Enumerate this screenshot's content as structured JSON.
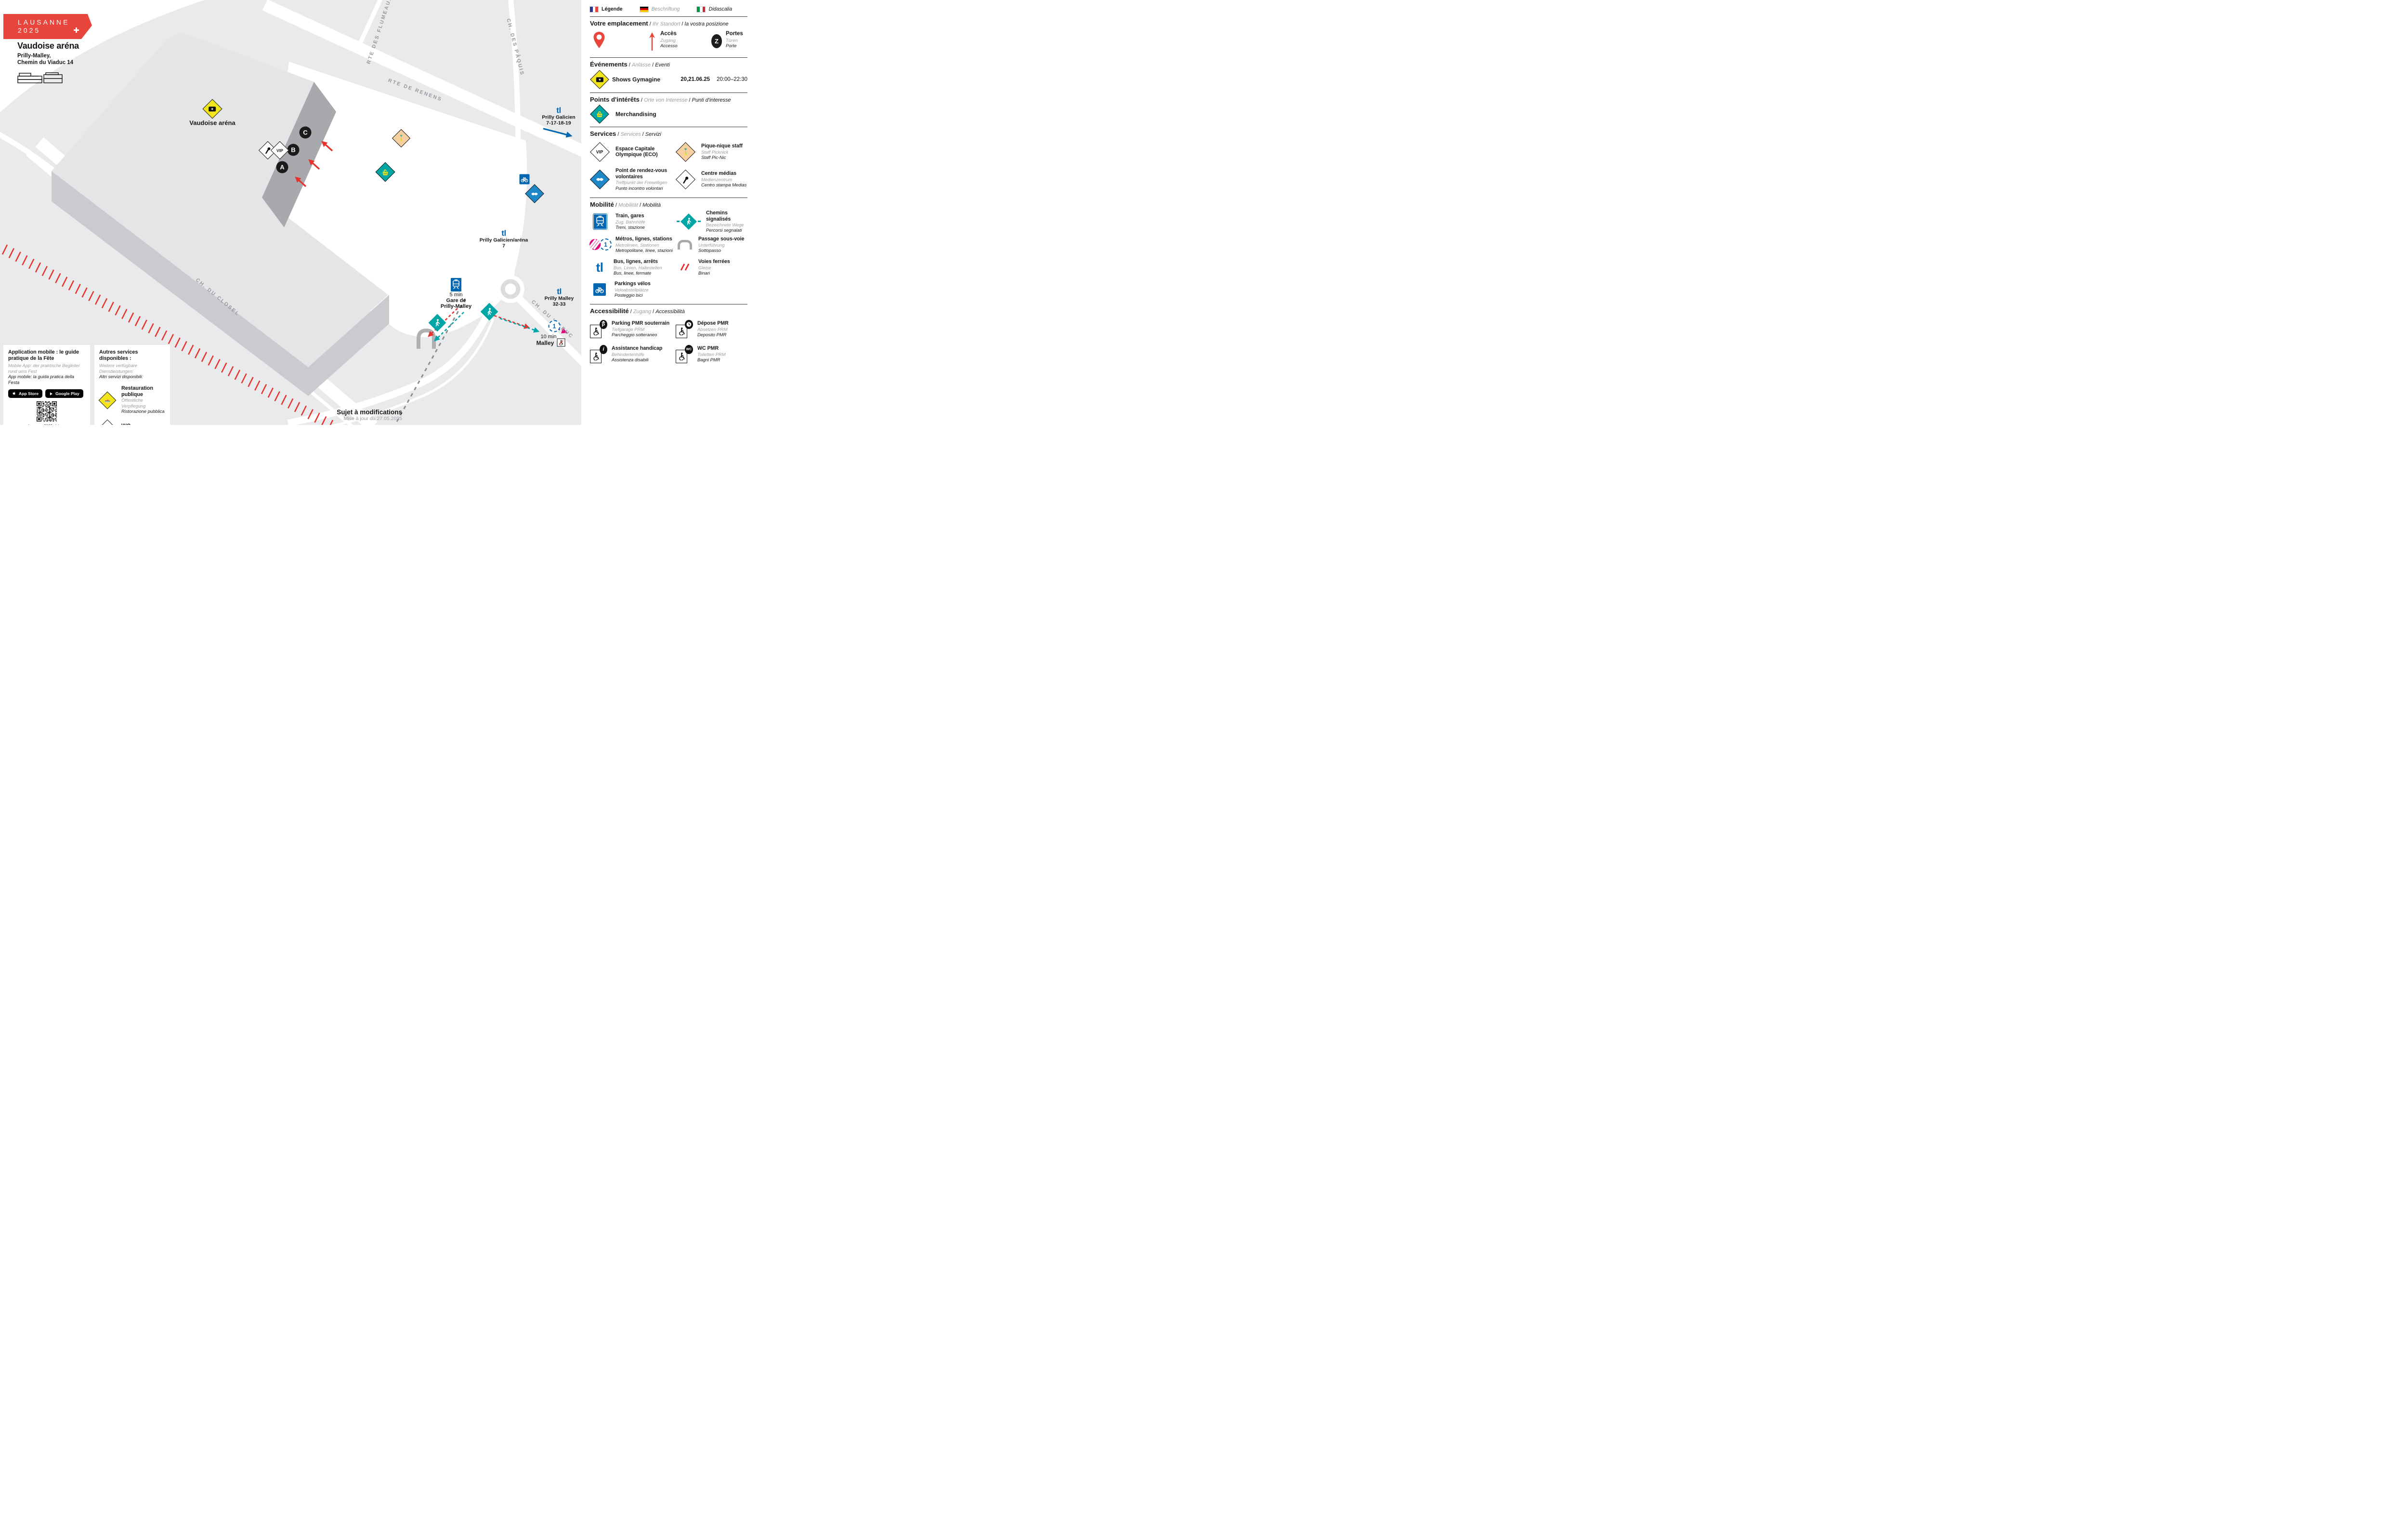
{
  "header": {
    "logo_line1": "LAUSANNE",
    "logo_line2": "2025",
    "title": "Vaudoise aréna",
    "address_line1": "Prilly-Malley,",
    "address_line2": "Chemin du Viaduc 14"
  },
  "map": {
    "arena_label": "Vaudoise aréna",
    "vip_label": "VIP",
    "doors": [
      "A",
      "B",
      "C"
    ],
    "roads": {
      "flumeaux": "RTE DES FLUMEAUX",
      "renens": "RTE DE RENENS",
      "paquis": "CH. DES PÂQUIS",
      "closel": "CH. DU CLOSEL",
      "viaduc": "CH. DU VIADUC"
    },
    "stops": {
      "galicien": {
        "logo": "tl",
        "name": "Prilly Galicien",
        "lines": "7-17-18-19"
      },
      "galicien_arena": {
        "logo": "tl",
        "name": "Prilly Galicien/aréna",
        "lines": "7"
      },
      "malley": {
        "logo": "tl",
        "name": "Prilly Malley",
        "lines": "32-33"
      }
    },
    "gare": {
      "time": "5 min",
      "name_line1": "Gare de",
      "name_line2": "Prilly-Malley"
    },
    "metro": {
      "line": "1",
      "time": "10 min",
      "name": "Malley"
    },
    "note": "Sujet à modifications",
    "updated": "Mise à jour du 27.05.2025"
  },
  "legend": {
    "languages": [
      {
        "label": "Légende"
      },
      {
        "label": "Beschriftung"
      },
      {
        "label": "Didascalia"
      }
    ],
    "location": {
      "fr": "Votre emplacement",
      "de": "Ihr Standort",
      "it": "la vostra posizione",
      "acces": {
        "fr": "Accès",
        "de": "Zugang",
        "it": "Accesso"
      },
      "portes": {
        "fr": "Portes",
        "de": "Türen",
        "it": "Porte",
        "badge": "Z"
      }
    },
    "events": {
      "fr": "Événements",
      "de": "Anlässe",
      "it": "Eventi",
      "rows": [
        {
          "label": "Shows Gymagine",
          "dates": "20,21.06.25",
          "time": "20:00–22:30"
        }
      ]
    },
    "poi": {
      "fr": "Points d'intérêts",
      "de": "Orte von Interesse",
      "it": "Punti d'interesse",
      "rows": [
        {
          "label": "Merchandising"
        }
      ]
    },
    "services": {
      "fr": "Services",
      "de": "Services",
      "it": "Servizi",
      "items": [
        {
          "fr": "Espace Capitale Olympique (ECO)",
          "de": "",
          "it": ""
        },
        {
          "fr": "Pique-nique staff",
          "de": "Staff Picknick",
          "it": "Staff Pic-Nic"
        },
        {
          "fr": "Point de rendez-vous volontaires",
          "de": "Treffpunkt der Freiwilligen",
          "it": "Punto incontro volontari"
        },
        {
          "fr": "Centre médias",
          "de": "Medienzentrum",
          "it": "Centro stampa Medias"
        }
      ]
    },
    "mobility": {
      "fr": "Mobilité",
      "de": "Mobilität",
      "it": "Mobilità",
      "items": [
        {
          "fr": "Train, gares",
          "de": "Zug, Bahnhöfe",
          "it": "Treni, stazione"
        },
        {
          "fr": "Chemins signalisés",
          "de": "Bezeichnete Wege",
          "it": "Percorsi segnalati"
        },
        {
          "fr": "Métros, lignes, stations",
          "de": "Metrolinien, Stationen",
          "it": "Metropolitane, linee, stazioni"
        },
        {
          "fr": "Passage sous-voie",
          "de": "Unterführung",
          "it": "Sottopasso"
        },
        {
          "fr": "Bus, lignes, arrêts",
          "de": "Bus, Linien, Haltestellen",
          "it": "Bus, linee, fermate"
        },
        {
          "fr": "Voies ferrées",
          "de": "Gleise",
          "it": "Binari"
        },
        {
          "fr": "Parkings vélos",
          "de": "Veloabstellplätze",
          "it": "Posteggio bici"
        }
      ]
    },
    "access": {
      "fr": "Accessibilité",
      "de": "Zugang",
      "it": "Accessibilità",
      "items": [
        {
          "fr": "Parking PMR souterrain",
          "de": "Tiefgarage PRM",
          "it": "Parcheggio sotteraneo"
        },
        {
          "fr": "Dépose PMR",
          "de": "Absetzen PRM",
          "it": "Deposito PMR"
        },
        {
          "fr": "Assistance handicap",
          "de": "Behindertenhilfe",
          "it": "Assistenza disabili"
        },
        {
          "fr": "WC PMR",
          "de": "Toiletten PRM",
          "it": "Bagni PMR"
        }
      ]
    }
  },
  "cards": {
    "app": {
      "title": "Application mobile : le guide pratique de la Fête",
      "de": "Mobile App: der praktische Begleiter rund ums Fest",
      "it": "App mobile: la guida pratica della Festa",
      "appstore": "App Store",
      "googleplay": "Google Play",
      "url": "lausanne2025.ch/app"
    },
    "other": {
      "title": "Autres services disponibles :",
      "de": "Weitere verfügbare Dienstleistungen:",
      "it": "Altri servizi disponibili:",
      "items": [
        {
          "fr": "Restauration publique",
          "de": "Öffentliche Verpflegung",
          "it": "Ristorazione pubblica"
        },
        {
          "fr": "WC",
          "de": "",
          "it": ""
        }
      ]
    }
  },
  "colors": {
    "accent_red": "#e8463c",
    "rail_red": "#e5332e",
    "teal": "#00a6a6",
    "tl_blue": "#0066b2",
    "volunteer_blue": "#1e87c8",
    "magenta": "#e5007d",
    "yellow": "#f3e51c",
    "peach": "#f8cf9e"
  }
}
